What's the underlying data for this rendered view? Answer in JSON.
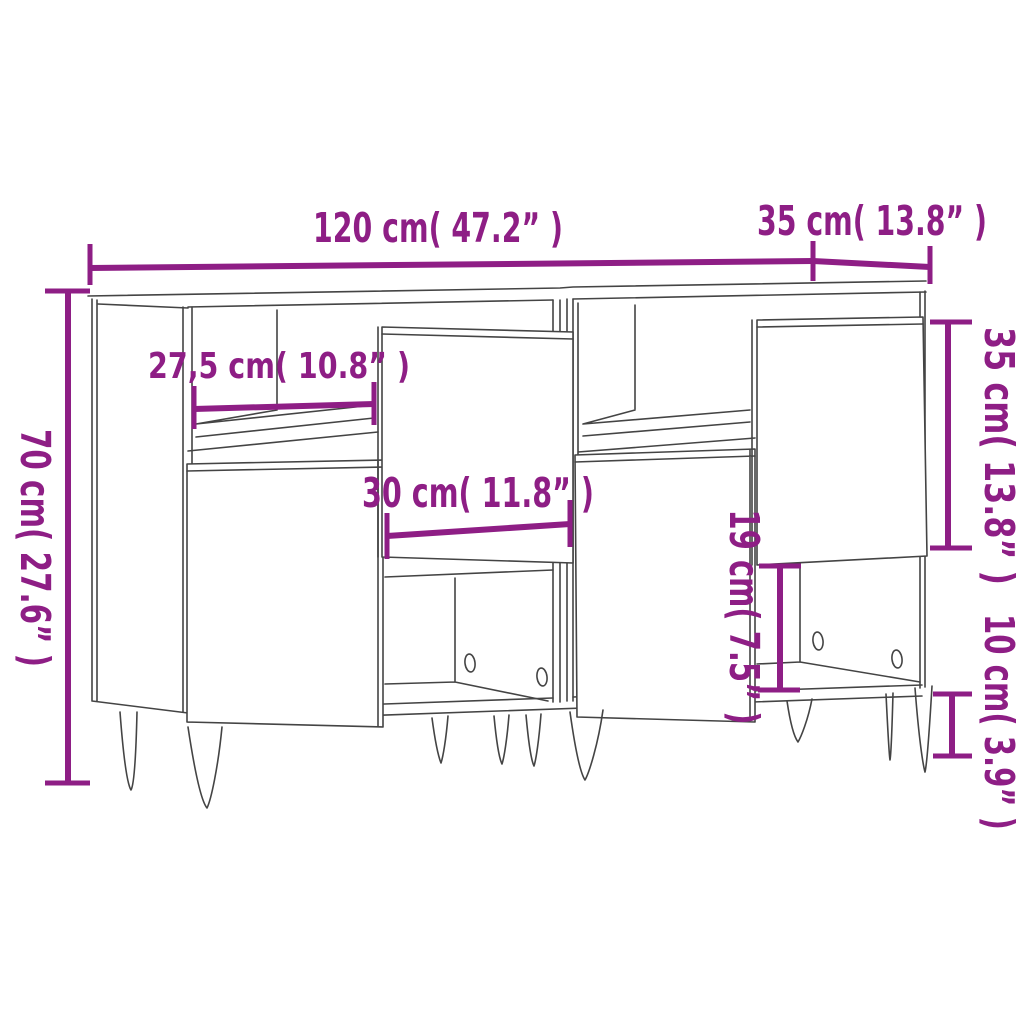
{
  "meta": {
    "accent_color": "#8e1e85",
    "line_color": "#444444",
    "background_color": "#ffffff",
    "diagram_type": "furniture-dimension-diagram",
    "subject": "two sideboards with hairpin legs, line drawing with measurements"
  },
  "dimensions": {
    "total_width": {
      "label": "120 cm( 47.2” )",
      "value_cm": "120",
      "value_inch": "47.2",
      "orientation": "horizontal"
    },
    "depth": {
      "label": "35 cm( 13.8” )",
      "value_cm": "35",
      "value_inch": "13.8",
      "orientation": "horizontal"
    },
    "total_height": {
      "label": "70 cm( 27.6” )",
      "value_cm": "70",
      "value_inch": "27.6",
      "orientation": "vertical"
    },
    "shelf_width": {
      "label": "27,5 cm( 10.8” )",
      "value_cm": "27,5",
      "value_inch": "10.8",
      "orientation": "horizontal"
    },
    "door_width": {
      "label": "30 cm( 11.8” )",
      "value_cm": "30",
      "value_inch": "11.8",
      "orientation": "horizontal"
    },
    "door_height": {
      "label": "35 cm( 13.8” )",
      "value_cm": "35",
      "value_inch": "13.8",
      "orientation": "vertical"
    },
    "niche_height": {
      "label": "19 cm( 7.5” )",
      "value_cm": "19",
      "value_inch": "7.5",
      "orientation": "vertical"
    },
    "leg_height": {
      "label": "10 cm( 3.9” )",
      "value_cm": "10",
      "value_inch": "3.9",
      "orientation": "vertical"
    }
  }
}
